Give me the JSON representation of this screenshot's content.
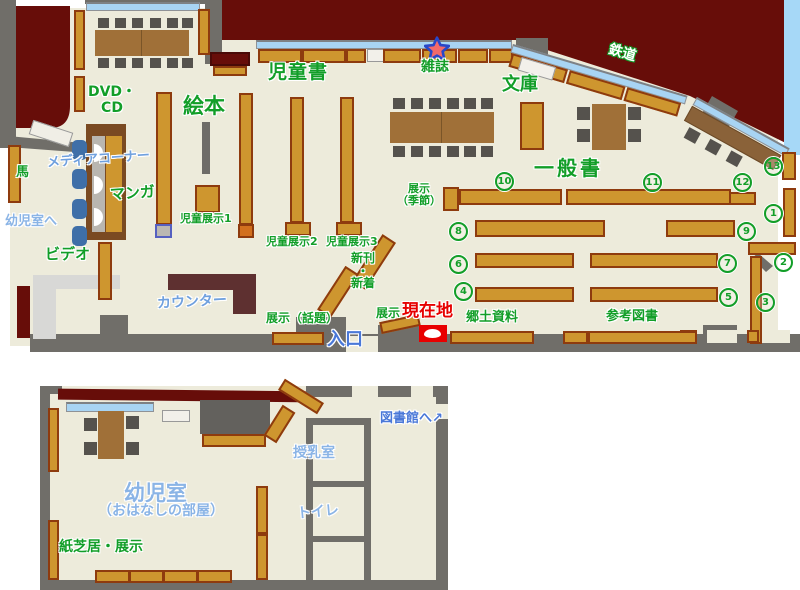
{
  "map": {
    "type": "library-floor-map",
    "areas": {
      "dvd_cd": "DVD・\nCD",
      "ehon": "絵本",
      "jidosho": "児童書",
      "zasshi": "雑誌",
      "bunko": "文庫",
      "tetsudo": "鉄道",
      "media_corner": "メディアコーナー",
      "uma": "馬",
      "manga": "マンガ",
      "to_infant_room": "幼児室へ",
      "video": "ビデオ",
      "counter": "カウンター",
      "tenji1": "児童展示1",
      "tenji2": "児童展示2",
      "tenji3": "児童展示3",
      "tenji_kisetsu": "展示\n（季節）",
      "ippansho": "一般書",
      "shinkan": "新刊\n・\n新着",
      "tenji_wadai": "展示（話題）",
      "tenji": "展示",
      "genzaichi": "現在地",
      "iriguchi": "入口",
      "kyodo": "郷土資料",
      "sanko": "参考図書",
      "to_library": "図書館へ",
      "junyu": "授乳室",
      "toilet": "トイレ",
      "infant_room": "幼児室",
      "infant_room_sub": "（おはなしの部屋）",
      "kamishibai": "紙芝居・展示"
    },
    "shelf_numbers": {
      "n1": "1",
      "n2": "2",
      "n3": "3",
      "n4": "4",
      "n5": "5",
      "n6": "6",
      "n7": "7",
      "n8": "8",
      "n9": "9",
      "n10": "10",
      "n11": "11",
      "n12": "12",
      "n13": "13"
    },
    "icons": {
      "exit_arrow": "↗"
    },
    "colors": {
      "floor": "#EDEBDB",
      "exterior": "#670D09",
      "shelf": "#CE962F",
      "shelf_border": "#8E3B0E",
      "wall": "#706E69",
      "window": "#A8D4F3",
      "sky": "#A6D8F7",
      "green_text": "#129E28",
      "blue_text": "#6FA0DE",
      "current_location_red": "#E60000",
      "counter_brown": "#5E3030",
      "table_brown": "#A07038"
    }
  }
}
